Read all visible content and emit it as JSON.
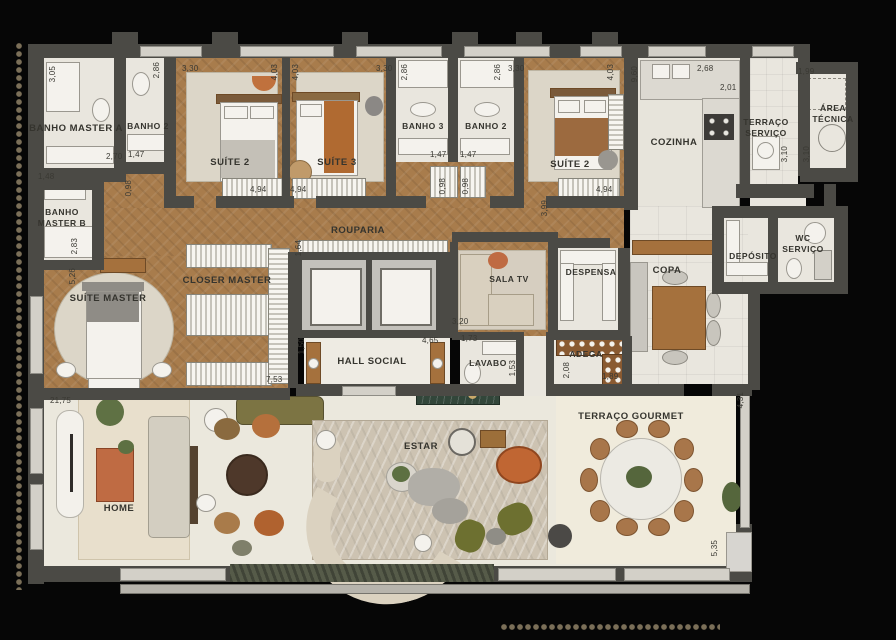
{
  "labels": {
    "banho_master_a": "BANHO MASTER A",
    "banho_2": "BANHO 2",
    "suite_2": "SUÍTE 2",
    "suite_3": "SUÍTE 3",
    "banho_3": "BANHO 3",
    "cozinha": "COZINHA",
    "terraco_servico": "TERRAÇO SERVIÇO",
    "area_tecnica": "ÁREA TÉCNICA",
    "banho_master_b": "BANHO MASTER B",
    "suite_master": "SUÍTE MASTER",
    "closer_master": "CLOSER MASTER",
    "rouparia": "ROUPARIA",
    "sala_tv": "SALA TV",
    "despensa": "DESPENSA",
    "copa": "COPA",
    "adega": "ADEGA",
    "deposito": "DEPÓSITO",
    "wc_servico": "WC SERVIÇO",
    "hall_social": "HALL SOCIAL",
    "lavabo": "LAVABO",
    "home": "HOME",
    "estar": "ESTAR",
    "terraco_gourmet": "TERRAÇO GOURMET"
  },
  "dims": {
    "d3_05": "3,05",
    "d2_70": "2,70",
    "d1_48": "1,48",
    "d1_47": "1,47",
    "d2_86": "2,86",
    "d3_30": "3,30",
    "d0_98": "0,98",
    "d4_03": "4,03",
    "d4_94": "4,94",
    "d9_60": "9,60",
    "d2_68": "2,68",
    "d2_01": "2,01",
    "d1_99": "1,99",
    "d3_10": "3,10",
    "d2_83": "2,83",
    "d5_26": "5,26",
    "d1_64": "1,64",
    "d3_99": "3,99",
    "d3_20": "3,20",
    "d1_73": "1,73",
    "d4_65": "4,65",
    "d1_50": "1,50",
    "d1_53": "1,53",
    "d2_08": "2,08",
    "d1_89": "1,89",
    "d7_53": "7,53",
    "d21_75": "21,75",
    "d4_31": "4,31",
    "d5_35": "5,35"
  },
  "colors": {
    "background": "#060606",
    "wall": "#4b4a45",
    "wood_floor": "#a87c4c",
    "tile_floor": "#e9e6de",
    "rug": "#dcd6c8",
    "text": "#35342e",
    "accent_terracotta": "#bf6b43",
    "accent_olive": "#6d7030",
    "accent_green_marble": "#32463a"
  }
}
